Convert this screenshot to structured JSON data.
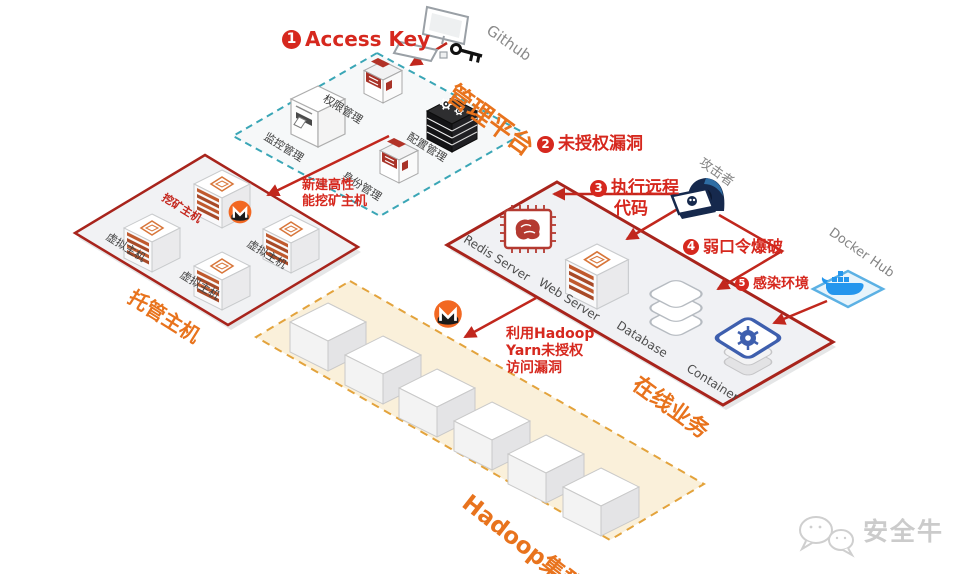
{
  "watermark": {
    "brand": "安全牛"
  },
  "external": {
    "github": "Github",
    "attacker": "攻击者",
    "docker_hub": "Docker Hub"
  },
  "steps": {
    "s1": {
      "num": "1",
      "label": "Access Key"
    },
    "s2": {
      "num": "2",
      "label": "未授权漏洞"
    },
    "s3": {
      "num": "3",
      "line1": "执行远程",
      "line2": "代码"
    },
    "s4": {
      "num": "4",
      "label": "弱口令爆破"
    },
    "s5": {
      "num": "5",
      "label": "感染环境"
    }
  },
  "notes": {
    "new_mining_host": {
      "line1": "新建高性",
      "line2": "能挖矿主机"
    },
    "hadoop_vuln": {
      "line1": "利用Hadoop",
      "line2": "Yarn未授权",
      "line3": "访问漏洞"
    }
  },
  "management_platform": {
    "label": "管理平台",
    "items": {
      "monitoring": "监控管理",
      "permission": "权限管理",
      "config": "配置管理",
      "identity": "身份管理"
    }
  },
  "hosting": {
    "label": "托管主机",
    "mining_host": "挖矿主机",
    "virtual_host": "虚拟主机"
  },
  "online_business": {
    "label": "在线业务",
    "items": {
      "redis": "Redis Server",
      "web": "Web Server",
      "database": "Database",
      "container": "Container"
    }
  },
  "hadoop": {
    "label": "Hadoop集群"
  },
  "colors": {
    "attack_red": "#c1271d",
    "text_red": "#d6281e",
    "accent_orange": "#e8731d",
    "teal_dashed": "#3aa6b6",
    "hadoop_border": "#e3a33c",
    "monero_orange": "#f26822",
    "docker_blue": "#2496ed",
    "kubernetes_blue": "#3e5fae"
  }
}
